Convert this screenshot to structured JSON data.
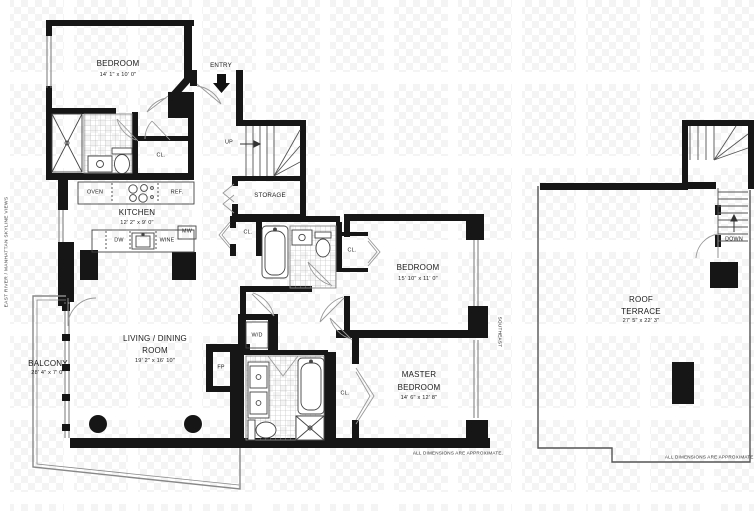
{
  "colors": {
    "wall": "#161616",
    "outline": "#555555",
    "paper": "#ffffff",
    "watermark": "#f4f4f4"
  },
  "side_notes": {
    "left_vertical": "EAST RIVER / MANHATTAN SKYLINE VIEWS",
    "southeast": "SOUTHEAST",
    "main_dimensions_note": "ALL DIMENSIONS ARE APPROXIMATE.",
    "terrace_dimensions_note": "ALL DIMENSIONS ARE APPROXIMATE."
  },
  "rooms": {
    "bedroom_top": {
      "name": "BEDROOM",
      "dims": "14' 1\" x 10' 0\""
    },
    "kitchen": {
      "name": "KITCHEN",
      "dims": "12' 2\" x 9' 0\""
    },
    "storage": {
      "name": "STORAGE"
    },
    "bedroom_middle": {
      "name": "BEDROOM",
      "dims": "15' 10\" x 11' 0\""
    },
    "living_dining": {
      "line1": "LIVING / DINING",
      "line2": "ROOM",
      "dims": "19' 2\" x 16' 10\""
    },
    "master_bedroom": {
      "line1": "MASTER",
      "line2": "BEDROOM",
      "dims": "14' 6\" x 12' 8\""
    },
    "balcony": {
      "name": "BALCONY",
      "dims": "28' 4\" x 7' 0\""
    },
    "roof_terrace": {
      "line1": "ROOF",
      "line2": "TERRACE",
      "dims": "27' 5\" x 22' 3\""
    }
  },
  "labels": {
    "entry": "ENTRY",
    "up": "UP",
    "down": "DOWN",
    "closet": "CL.",
    "oven": "OVEN",
    "refrigerator": "REF.",
    "dishwasher": "DW",
    "wine": "WINE",
    "microwave": "MW",
    "washer_dryer": "W/D",
    "fireplace": "FP"
  }
}
